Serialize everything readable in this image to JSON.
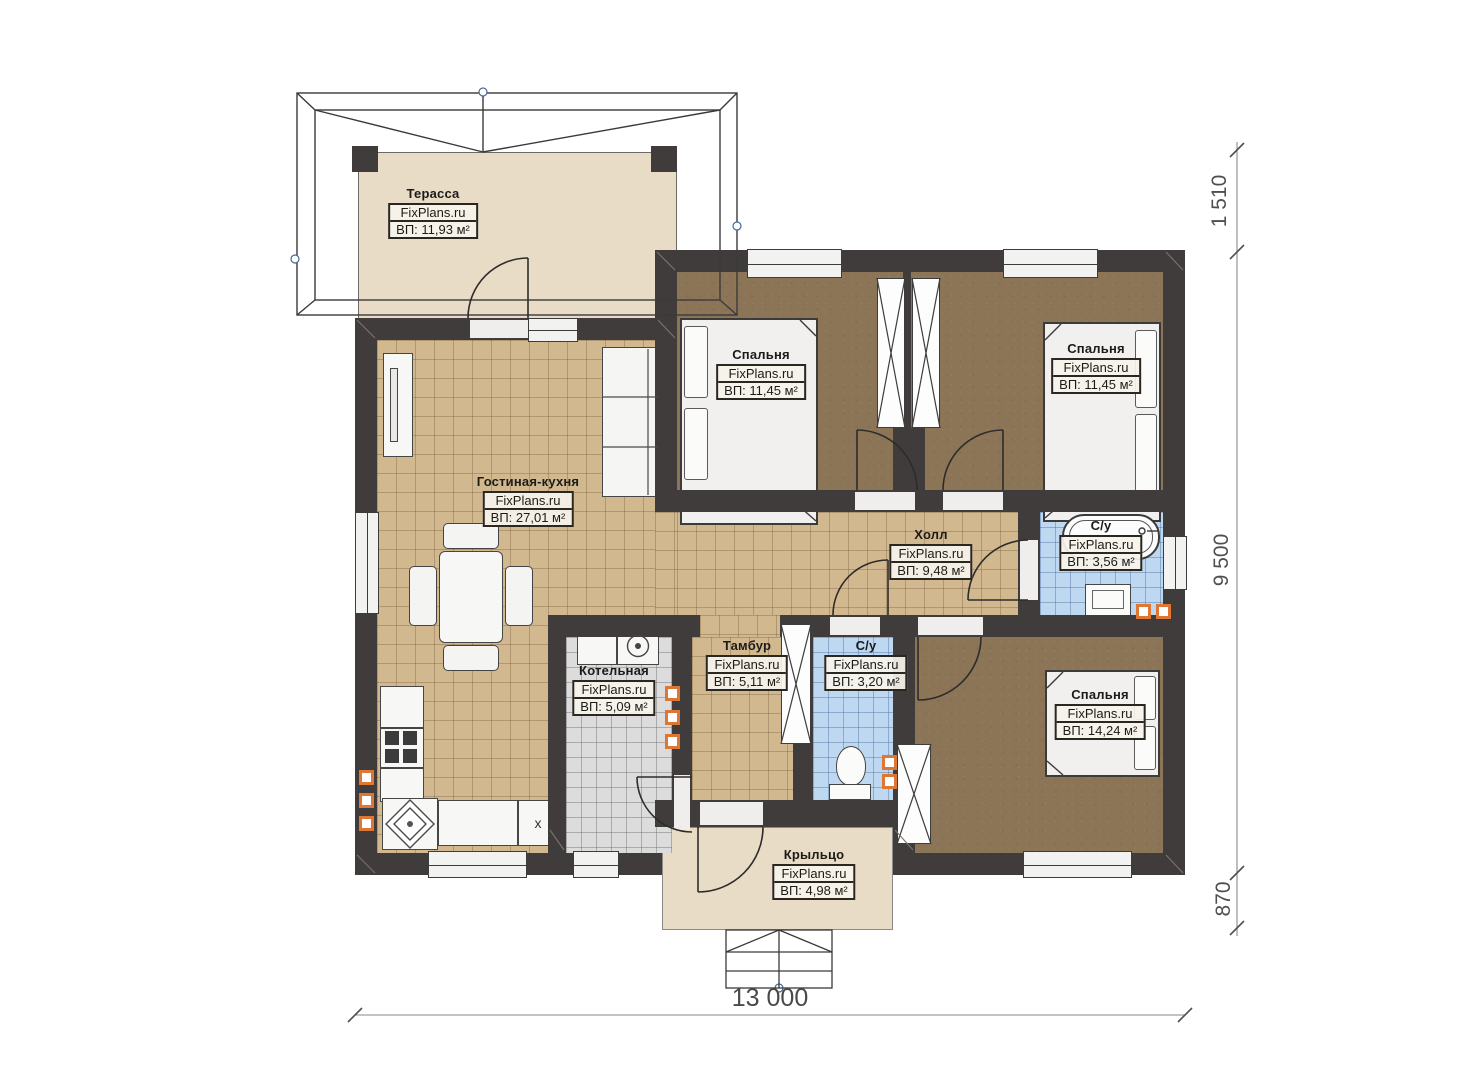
{
  "plan": {
    "brand": "FixPlans.ru",
    "rooms": {
      "terrace": {
        "name": "Терасса",
        "brand": "FixPlans.ru",
        "area": "ВП: 11,93 м²"
      },
      "living_kitchen": {
        "name": "Гостиная-кухня",
        "brand": "FixPlans.ru",
        "area": "ВП: 27,01 м²"
      },
      "bedroom_top_left": {
        "name": "Спальня",
        "brand": "FixPlans.ru",
        "area": "ВП: 11,45 м²"
      },
      "bedroom_top_right": {
        "name": "Спальня",
        "brand": "FixPlans.ru",
        "area": "ВП: 11,45 м²"
      },
      "hall": {
        "name": "Холл",
        "brand": "FixPlans.ru",
        "area": "ВП: 9,48 м²"
      },
      "bathroom_main": {
        "name": "С/у",
        "brand": "FixPlans.ru",
        "area": "ВП: 3,56 м²"
      },
      "boiler": {
        "name": "Котельная",
        "brand": "FixPlans.ru",
        "area": "ВП: 5,09 м²"
      },
      "vestibule": {
        "name": "Тамбур",
        "brand": "FixPlans.ru",
        "area": "ВП: 5,11 м²"
      },
      "bathroom_small": {
        "name": "С/у",
        "brand": "FixPlans.ru",
        "area": "ВП: 3,20 м²"
      },
      "bedroom_bottom": {
        "name": "Спальня",
        "brand": "FixPlans.ru",
        "area": "ВП: 14,24 м²"
      },
      "porch": {
        "name": "Крыльцо",
        "brand": "FixPlans.ru",
        "area": "ВП: 4,98 м²"
      }
    },
    "dimensions": {
      "right_top": "1 510",
      "right_main": "9 500",
      "right_bottom": "870",
      "bottom_total": "13 000"
    },
    "symbols": {
      "kitchen_x": "x"
    },
    "colors": {
      "wall": "#403c3b",
      "terrace_floor": "#e8dcc6",
      "tile_tan": "#d2b88e",
      "floor_brown": "#8c7557",
      "tile_blue": "#bed8f2",
      "tile_gray": "#dcdcdc",
      "vent_accent": "#dd7733"
    }
  }
}
